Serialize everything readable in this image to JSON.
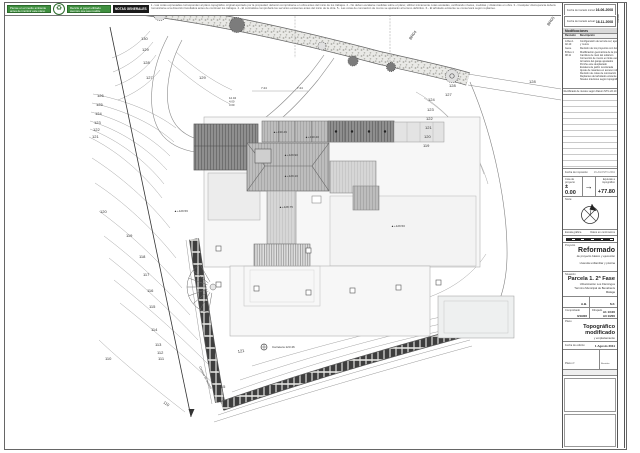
{
  "top_bar": {
    "eco_badge_1": "Piense en el medio ambiente antes de imprimir este plano",
    "eco_badge_2": "Recicle el papel utilizado siempre que sea posible",
    "recycle_icon": "recycle-symbol",
    "notes_title": "NOTAS GENERALES",
    "notes_text": "1.- Las cotas expresadas corresponden al plano topográfico original aportado por la propiedad; deberán comprobarse en obra antes del inicio de los trabajos.  2.- No deben escalarse medidas sobre el plano; utilizar únicamente cotas acotadas, verificando niveles, medidas y distancias en obra.  3.- Cualquier discrepancia deberá comunicarse a la dirección facultativa antes de continuar los trabajos.  4.- El contratista comprobará los servicios existentes antes del inicio de la obra.  5.- Las cotas de coronación de muros se ajustarán al terreno definitivo.  6.- El arbolado existente se conservará según replanteo."
  },
  "titleblock": {
    "strip_label": "Formato",
    "date1_label": "Fecha de trazado inicial:",
    "date1_value": "16-06-2008",
    "date2_label": "Fecha de trazado actual:",
    "date2_value": "16-11-2008",
    "mods_title": "Modificaciones",
    "mods_col_rev": "Revisión",
    "mods_col_desc": "Descripción",
    "mods_rows": [
      {
        "rev": "A Rev.1 02.10",
        "desc": [
          "Configuración de terraza sur; ajuste de taludes",
          "y muros"
        ]
      },
      {
        "rev": "Gene.",
        "desc": [
          "Revisión de los proyectos con fecha 09 marzo 2011"
        ]
      },
      {
        "rev": "B Rev.1 08.11",
        "desc": [
          "Modificación geométrica de la piscina",
          "Cambios de nivel del solárium",
          "Corrección de muros en linde oeste",
          "Armarios del garaje ajustados",
          "Porche este desplazado",
          "Escalera de jardín recolocada",
          "Ajuste de rasantes en acceso rodado",
          "Revisión de cotas de coronación de muros",
          "Replanteo del arbolado existente",
          "Niveles interiores según topográfico"
        ]
      }
    ],
    "mods_note": "Rectificado de niveles según Datum NTG 22.10",
    "print_label": "Fecha de impresión",
    "print_value": "16-AGOSTO-2011",
    "cota_label": "Cota de proyecto",
    "cota_value": "± 0.00",
    "arrow_icon": "→",
    "equiv_label": "Equivale a topográfico",
    "equiv_value": "+77.80",
    "norte_label": "Norte:",
    "escala_grafica_label": "Escala gráfica",
    "datos_label": "Datos en centímetros",
    "proyecto_label": "Proyecto",
    "proyecto_title": "Reformado",
    "proyecto_sub": "de proyecto básico y ejecución",
    "proyecto_sub2": "vivienda unifamiliar y piscina",
    "situacion_label": "Situación",
    "situacion_title": "Parcela 1. 2ª Fase",
    "situacion_lines": [
      "Urbanización Los Flamingos",
      "Término Municipal de Benahavís",
      "Málaga"
    ],
    "comprobado_label": "Comprobado",
    "comprobado_value": "A.B.",
    "dibujado_label": "Dibujado",
    "dibujado_value": "S.F.",
    "proyecto_num_label": "Proyecto nº",
    "proyecto_num_value": "0/19/06",
    "escala_label": "Escala",
    "escala_value1": "A1 1/100",
    "escala_value2": "A3 1/200",
    "plano_label": "Plano",
    "plano_title1": "Topográfico",
    "plano_title2": "modificado",
    "plano_sub": "y emplazamiento",
    "fecha_edicion_label": "Fecha de edición",
    "fecha_edicion_value": "1 Agosto 2011",
    "plano_num_label": "Plano nº",
    "plano_num_value": "04.1",
    "revision_label": "Revisión",
    "revision_value": "B",
    "referencia_label": "Referencia"
  },
  "plan": {
    "labels": [
      {
        "t": "130",
        "x": 141,
        "y": 40
      },
      {
        "t": "129",
        "x": 142,
        "y": 51
      },
      {
        "t": "128",
        "x": 143,
        "y": 64
      },
      {
        "t": "127",
        "x": 146,
        "y": 79
      },
      {
        "t": "126",
        "x": 97,
        "y": 97
      },
      {
        "t": "125",
        "x": 96,
        "y": 106
      },
      {
        "t": "124",
        "x": 95,
        "y": 115
      },
      {
        "t": "123",
        "x": 94,
        "y": 124
      },
      {
        "t": "122",
        "x": 93,
        "y": 131
      },
      {
        "t": "121",
        "x": 92,
        "y": 138
      },
      {
        "t": "120",
        "x": 100,
        "y": 213
      },
      {
        "t": "119",
        "x": 126,
        "y": 237
      },
      {
        "t": "118",
        "x": 139,
        "y": 258
      },
      {
        "t": "117",
        "x": 143,
        "y": 276
      },
      {
        "t": "116",
        "x": 147,
        "y": 292
      },
      {
        "t": "115",
        "x": 149,
        "y": 308
      },
      {
        "t": "114",
        "x": 151,
        "y": 331
      },
      {
        "t": "113",
        "x": 155,
        "y": 346
      },
      {
        "t": "112",
        "x": 157,
        "y": 354
      },
      {
        "t": "111",
        "x": 158,
        "y": 360
      },
      {
        "t": "110",
        "x": 105,
        "y": 360
      },
      {
        "t": "110",
        "x": 163,
        "y": 403,
        "r": 35
      },
      {
        "t": "129",
        "x": 199,
        "y": 79
      },
      {
        "t": "124",
        "x": 428,
        "y": 101
      },
      {
        "t": "123",
        "x": 427,
        "y": 111
      },
      {
        "t": "122",
        "x": 426,
        "y": 120
      },
      {
        "t": "121",
        "x": 425,
        "y": 129
      },
      {
        "t": "120",
        "x": 424,
        "y": 138
      },
      {
        "t": "119",
        "x": 423,
        "y": 147
      },
      {
        "t": "128",
        "x": 449,
        "y": 87
      },
      {
        "t": "127",
        "x": 445,
        "y": 96
      },
      {
        "t": "128",
        "x": 529,
        "y": 83
      },
      {
        "t": "BR04",
        "x": 411,
        "y": 40,
        "r": -55
      },
      {
        "t": "BR05",
        "x": 549,
        "y": 26,
        "r": -55
      },
      {
        "t": "121",
        "x": 238,
        "y": 353,
        "r": -10
      },
      {
        "t": "115",
        "x": 219,
        "y": 388
      },
      {
        "t": "Camino de acceso",
        "x": 199,
        "y": 367,
        "r": 63,
        "s": 3
      },
      {
        "t": "Carretera 123.46",
        "x": 272,
        "y": 348,
        "s": 3
      },
      {
        "t": "7.24",
        "x": 261,
        "y": 89,
        "s": 3
      },
      {
        "t": "7.24",
        "x": 297,
        "y": 89,
        "s": 3
      },
      {
        "t": "12.04",
        "x": 229,
        "y": 99,
        "s": 2.8
      },
      {
        "t": "4.00",
        "x": 229,
        "y": 102.6,
        "s": 2.8
      },
      {
        "t": "3.00",
        "x": 229,
        "y": 106.2,
        "s": 2.8
      },
      {
        "t": "▲+130.49",
        "x": 273,
        "y": 133,
        "s": 3
      },
      {
        "t": "▲+130.40",
        "x": 305,
        "y": 138,
        "s": 3
      },
      {
        "t": "▲+129.90",
        "x": 284,
        "y": 156,
        "s": 3
      },
      {
        "t": "▲+129.10",
        "x": 284,
        "y": 177,
        "s": 3
      },
      {
        "t": "▲+128.75",
        "x": 279,
        "y": 208,
        "s": 3
      },
      {
        "t": "▲+129.56",
        "x": 174,
        "y": 212,
        "s": 3
      },
      {
        "t": "▲+129.50",
        "x": 391,
        "y": 227,
        "s": 3
      }
    ]
  }
}
